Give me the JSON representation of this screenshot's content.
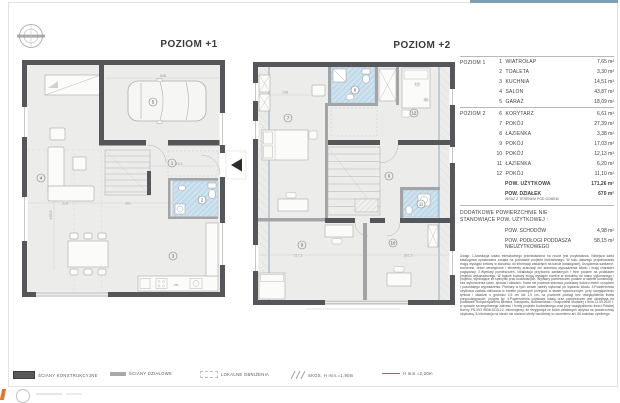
{
  "header": {
    "top_bar_color": "#7e9eb5"
  },
  "plans": [
    {
      "title": "POZIOM +1",
      "rooms": {
        "hall": "1",
        "toilet": "2",
        "kitchen": "3",
        "salon": "4",
        "garage": "5"
      },
      "dims": {
        "garage": "548",
        "hall": "443,5",
        "salon_a": "318",
        "salon_b": "361",
        "salon_v": "435,5"
      },
      "kitchen_tag": "ZM"
    },
    {
      "title": "POZIOM +2",
      "rooms": {
        "corridor": "6",
        "bedroom_left": "7",
        "bath_top": "8",
        "bedroom_bl": "9",
        "bedroom_br": "10",
        "bath_mid": "11",
        "bedroom_tr": "12"
      },
      "dims": {
        "bed": "148",
        "a": "7,5",
        "b": "58",
        "bottom_a": "517,5",
        "bottom_b": "381,5"
      }
    }
  ],
  "table": {
    "sections": [
      {
        "label": "POZIOM 1",
        "rows": [
          {
            "num": "1",
            "name": "WIATROŁAP",
            "area": "7,65 m²"
          },
          {
            "num": "2",
            "name": "TOALETA",
            "area": "3,30 m²"
          },
          {
            "num": "3",
            "name": "KUCHNIA",
            "area": "14,51 m²"
          },
          {
            "num": "4",
            "name": "SALON",
            "area": "43,87 m²"
          },
          {
            "num": "5",
            "name": "GARAŻ",
            "area": "18,09 m²"
          }
        ]
      },
      {
        "label": "POZIOM 2",
        "rows": [
          {
            "num": "6",
            "name": "KORYTARZ",
            "area": "6,61 m²"
          },
          {
            "num": "7",
            "name": "POKÓJ",
            "area": "27,39 m²"
          },
          {
            "num": "8",
            "name": "ŁAZIENKA",
            "area": "3,38 m²"
          },
          {
            "num": "9",
            "name": "POKÓJ",
            "area": "17,03 m²"
          },
          {
            "num": "10",
            "name": "POKÓJ",
            "area": "12,13 m²"
          },
          {
            "num": "11",
            "name": "ŁAZIENKA",
            "area": "6,20 m²"
          },
          {
            "num": "12",
            "name": "POKÓJ",
            "area": "11,10 m²"
          }
        ]
      }
    ],
    "usable": {
      "name": "POW. UŻYTKOWA",
      "area": "171,26 m²"
    },
    "plot": {
      "name": "POW. DZIAŁEK",
      "sub": "WRAZ Z TERENEM POD DOMEM",
      "area": "670 m²"
    },
    "additional_header_line1": "DODATKOWE POWIERZCHNIE NIE",
    "additional_header_line2": "STANOWIĄCE POW. UŻYTKOWEJ :",
    "additional": [
      {
        "name": "POW. SCHODÓW",
        "name2": "",
        "area": "4,98 m²"
      },
      {
        "name": "POW. PODŁOGI PODDASZA",
        "name2": "NIEUŻYTKOWEGO",
        "area": "58,15 m²"
      }
    ],
    "notes": "Uwagi: 1.Aranżacja lokalu mieszkalnego przedstawiona na rzucie jest przykładowa. Niniejsza karta katalogowa opracowana została na podstawie projektu budowlanego. W toku dalszego projektowania mogą wystąpić zmiany w stosunku do informacji zawartych na karcie katalogowej. Urządzenia sanitarne, kuchenne, drzwi wewnętrzne i elementy aranżacji nie stanowią wyposażenia lokalu i mają charakter poglądowy. 2.Wymiary pomieszczeń, lokalizacja przyborów sanitarnych i inne podane na podstawie projektu wykonawczego. W trakcie budowy mogą wystąpić różnice w stosunku do stanu wykonanego i projektu, wynikające ze specyfiki prac budowlanych. Wymiary pomieszczeń podane w świetle konstrukcji, bez wykończenia ścian, tynków i okładzin. Karta nie powinna stanowić podstawy doboru mebli, urządzeń i pozostałego wyposażenia. Pomiary w tych celach należy wykonać po wydaniu lokalu. 3.Powierzchnia użytkowa została obliczona w świetle pionowych przegród w stanie wykończonym, przy uwzględnieniu tynków i okładzin o grubości 0,5 cm lub 1,5 cm, na poziomie podłogi bez uwzględnienia listew przypodłogowych, progów itp. 4.Powierzchnia użytkowa lokalu oraz pomieszczeń jest określana na podstawie Rozporządzenia Ministra Transportu, Budownictwa i Gospodarki Morskiej z dnia 11.09.2020 r. w sprawie szczegółowego zakresu i formy projektu budowlanego oraz przy uwzględnieniu treści Polskiej Normy PN-ISO 9836:2015-12. Informujemy, że rezygnacja ze ścian działowych wpływa na powierzchnię użytkową. 5.Informacja na karcie nie stanowi oferty handlowej w rozumieniu art. 66 kodeksu cywilnego."
  },
  "legend": {
    "items": [
      {
        "label": "ŚCIANY KONSTRUKCYJNE"
      },
      {
        "label": "ŚCIANY DZIAŁOWE"
      },
      {
        "label": "LOKALNE OBNIŻENIA"
      },
      {
        "label": "SKOS, H min.=1,90m"
      },
      {
        "label": "H min.=2,20m"
      }
    ]
  }
}
